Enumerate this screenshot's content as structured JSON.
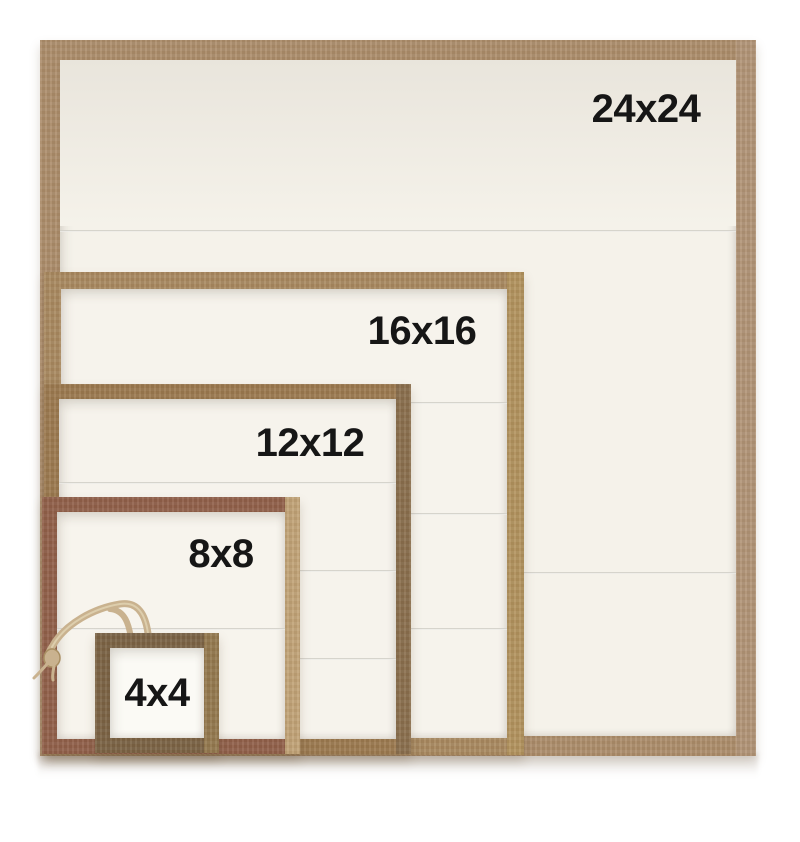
{
  "image": {
    "background": "#ffffff",
    "width": 800,
    "height": 842,
    "label_color": "#161616"
  },
  "frames": [
    {
      "id": "24x24",
      "label": "24x24",
      "left": 40,
      "top": 40,
      "width": 716,
      "height": 716,
      "border": 20,
      "wood": "#ad8e6c",
      "wood_edge": "#b29578",
      "interior": "#f5f2ea",
      "label_cx": 646,
      "label_cy": 109,
      "plank_lines": [
        230,
        572
      ],
      "top_band": {
        "from": 60,
        "to": 226,
        "color_top": "#e9e5dc",
        "color_bottom": "#f5f2ea"
      }
    },
    {
      "id": "16x16",
      "label": "16x16",
      "left": 44,
      "top": 272,
      "width": 480,
      "height": 483,
      "border": 17,
      "wood": "#a98a61",
      "wood_edge": "#b3945f",
      "interior": "#f6f3ec",
      "label_cx": 422,
      "label_cy": 331,
      "plank_lines": [
        402,
        513,
        628
      ]
    },
    {
      "id": "12x12",
      "label": "12x12",
      "left": 44,
      "top": 384,
      "width": 367,
      "height": 370,
      "border": 15,
      "wood": "#9c7a50",
      "wood_edge": "#8a6f4e",
      "interior": "#f6f3ec",
      "label_cx": 310,
      "label_cy": 443,
      "plank_lines": [
        482,
        570,
        658
      ]
    },
    {
      "id": "8x8",
      "label": "8x8",
      "left": 42,
      "top": 497,
      "width": 258,
      "height": 257,
      "border": 15,
      "wood": "#91604a",
      "wood_edge": "#c2a478",
      "interior": "#f7f4ed",
      "label_cx": 221,
      "label_cy": 554,
      "plank_lines": [
        628
      ]
    },
    {
      "id": "4x4",
      "label": "4x4",
      "left": 95,
      "top": 633,
      "width": 124,
      "height": 120,
      "border": 15,
      "wood": "#7b6345",
      "wood_edge": "#94794f",
      "interior": "#fbfaf5",
      "label_cx": 157,
      "label_cy": 693,
      "plank_lines": []
    }
  ],
  "twine": {
    "color": "#c9b28f",
    "highlight": "#e2d4b4",
    "knot_stroke": "#a98f63"
  }
}
